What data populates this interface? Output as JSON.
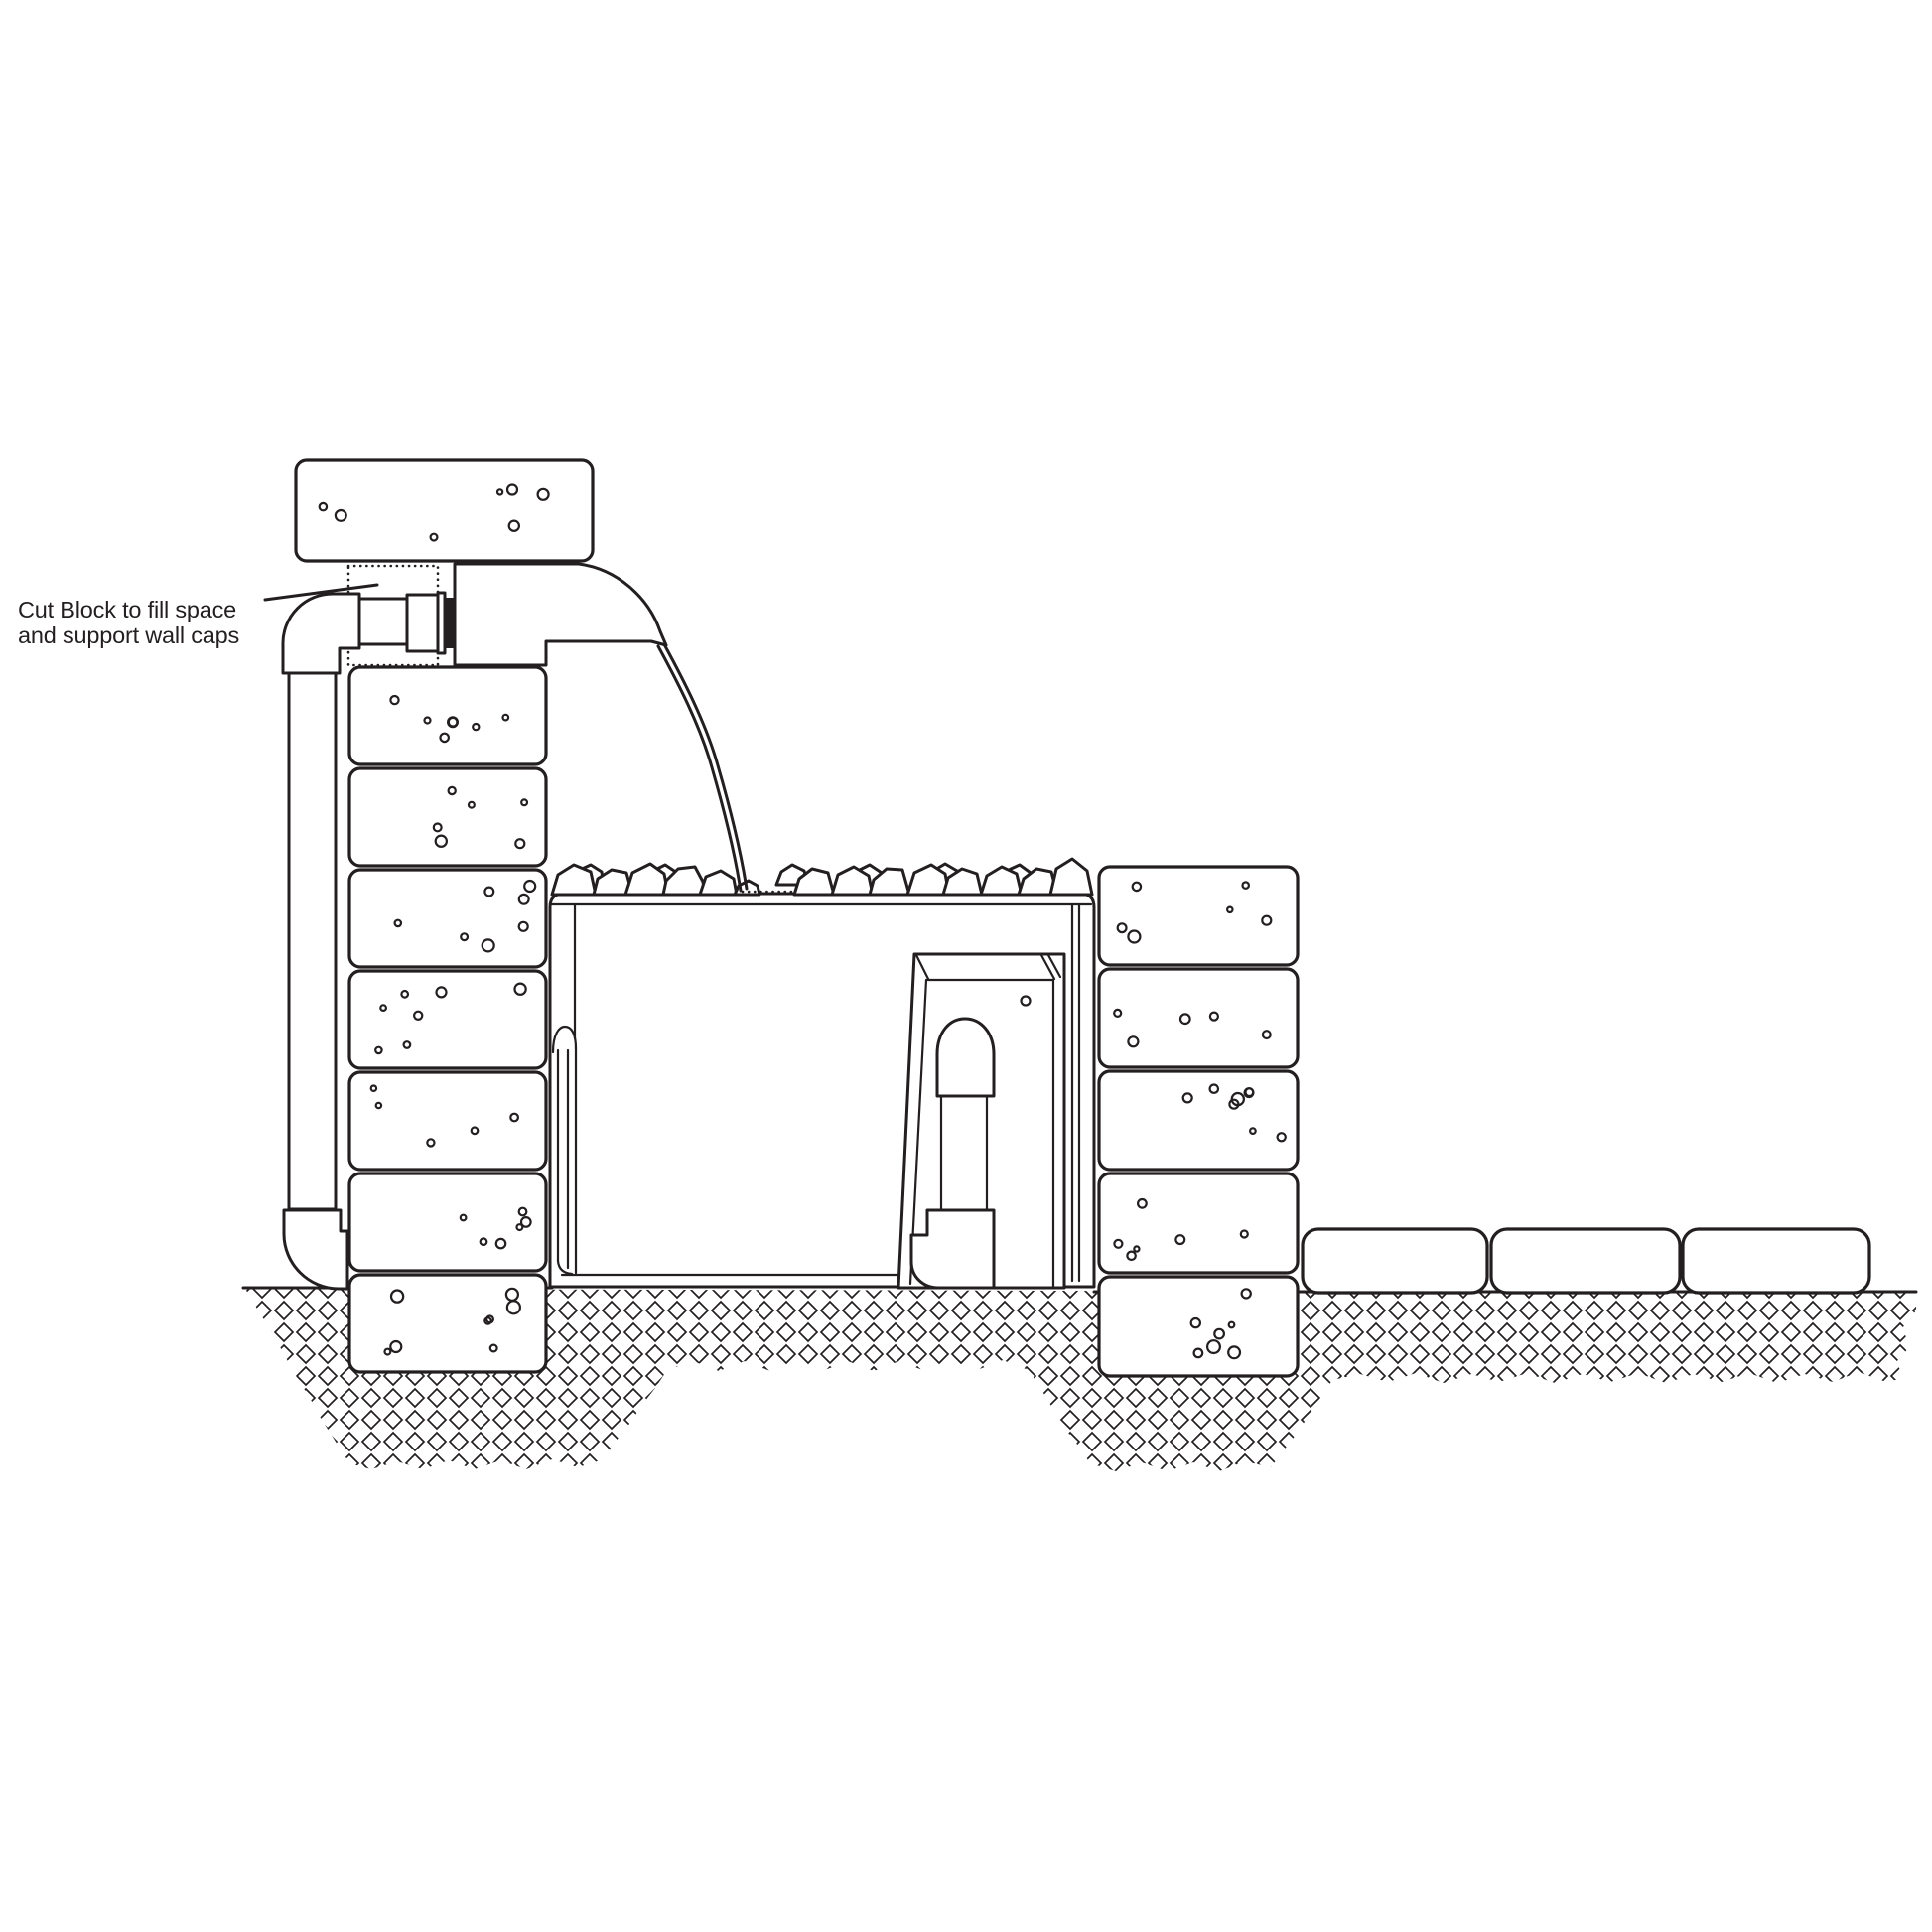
{
  "annotation": {
    "line1": "Cut Block to fill space",
    "line2": "and support wall caps"
  },
  "colors": {
    "ink": "#231f20",
    "paper": "#ffffff"
  },
  "components": [
    "wall-cap-block",
    "cut-filler-block-dashed",
    "supply-pipe-vertical",
    "supply-pipe-elbow-top",
    "supply-pipe-elbow-bottom",
    "pipe-coupling",
    "bulkhead-flange",
    "bulkhead-gasket",
    "waterfall-spillway",
    "water-stream",
    "rock-layer",
    "grate-dotted-line",
    "basin-reservoir",
    "basin-liner",
    "pump-vault",
    "vault-pipe-assembly",
    "left-retaining-wall-column",
    "right-retaining-wall-column",
    "buried-base-blocks",
    "ground-paver-blocks",
    "excavation-ground-hatch"
  ]
}
